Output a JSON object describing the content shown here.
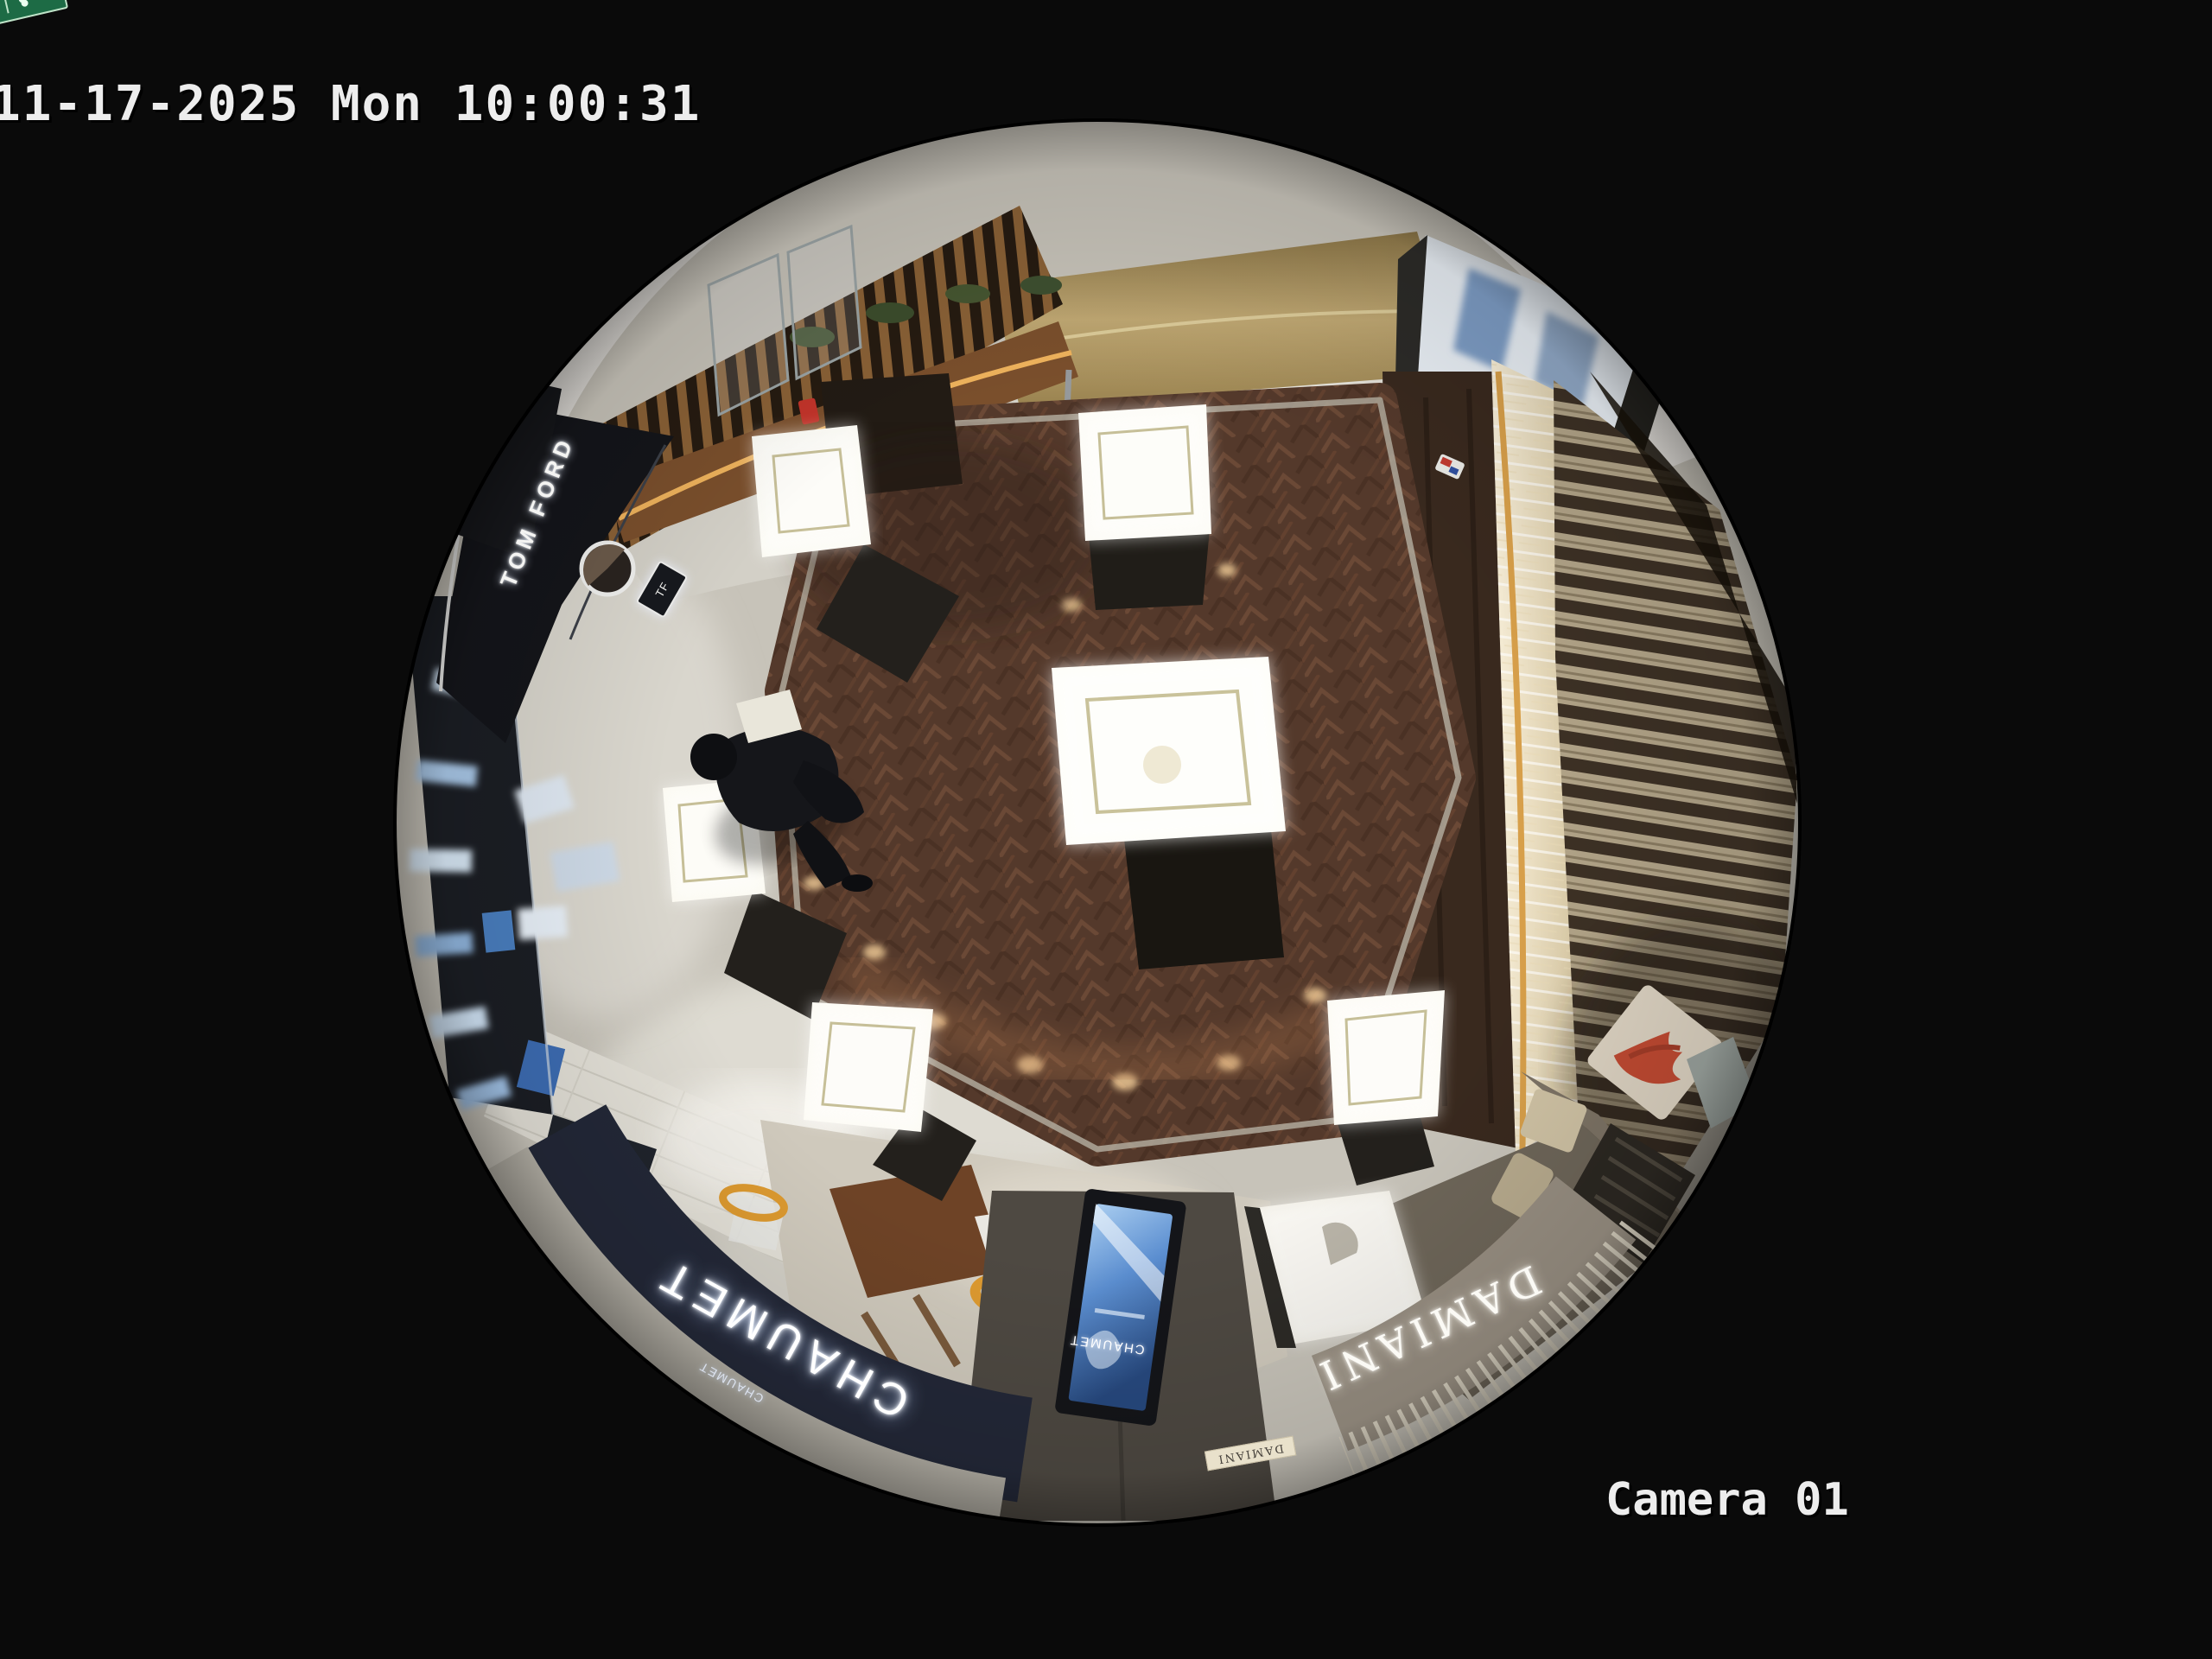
{
  "osd": {
    "timestamp": "11-17-2025 Mon 10:00:31",
    "camera_label": "Camera 01"
  },
  "scene": {
    "view": "ceiling-fisheye-camera",
    "location": "luxury-jewelry-retail-floor",
    "signs": {
      "chaumet_fascia": "CHAUMET",
      "chaumet_small": "CHAUMET",
      "damiani_fascia": "DAMIANI",
      "damiani_directory": "DAMIANI",
      "tomford_storefront": "TOM FORD",
      "tf_monogram": "TF",
      "exit_label": "EXIT",
      "screen_brand": "CHAUMET"
    },
    "colors": {
      "background": "#0a0a0a",
      "osd_text": "#ededed",
      "wood_floor": "#5a3c2d",
      "stone_floor": "#c9c5bb",
      "chaumet_fascia_navy": "#232838",
      "damiani_fascia_taupe": "#9a9184",
      "exit_green": "#1d6b45",
      "screen_blue": "#3f6fb0",
      "gold_wall": "#a8905c",
      "slat_wood": "#403426"
    }
  }
}
